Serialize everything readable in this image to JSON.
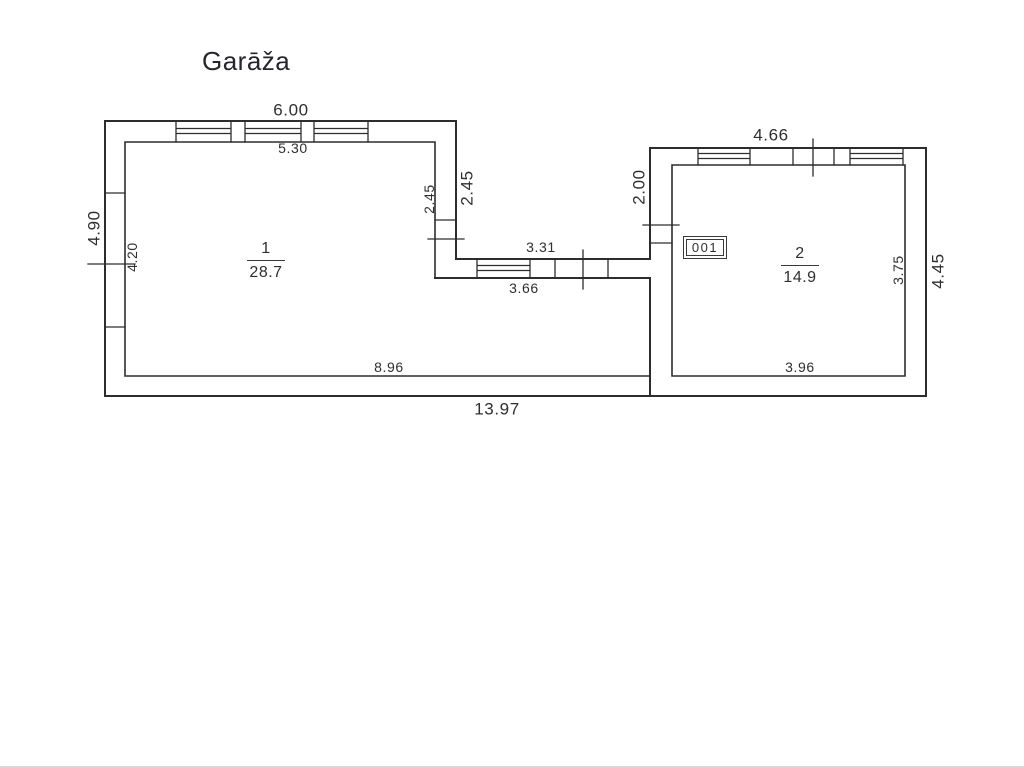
{
  "title": "Garāža",
  "floor_plan": {
    "unit_label": "001",
    "rooms": [
      {
        "number": "1",
        "area": "28.7"
      },
      {
        "number": "2",
        "area": "14.9"
      }
    ],
    "dims": {
      "top_outer": "6.00",
      "top_inner": "5.30",
      "left_outer": "4.90",
      "left_inner": "4.20",
      "notch_inner": "2.45",
      "notch_outer": "2.45",
      "mid_top": "3.31",
      "mid_bottom": "3.66",
      "room2_left": "2.00",
      "room2_top": "4.66",
      "room2_right_inner": "3.75",
      "room2_right_outer": "4.45",
      "room1_bottom": "8.96",
      "room2_bottom": "3.96",
      "bottom_outer": "13.97"
    }
  }
}
